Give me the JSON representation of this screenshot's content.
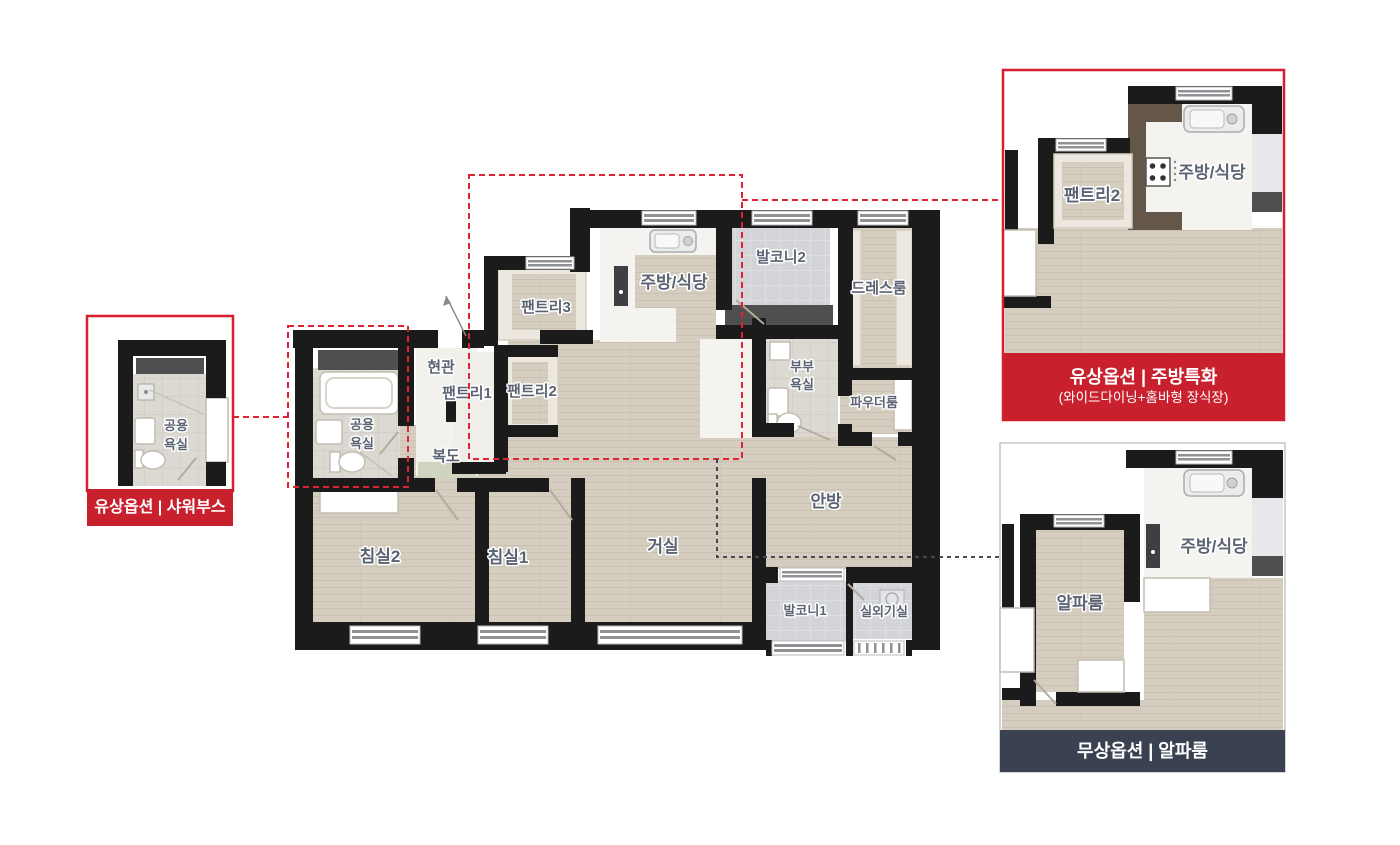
{
  "floorplan": {
    "labels": {
      "entrance": "현관",
      "pantry1": "팬트리1",
      "pantry2": "팬트리2",
      "pantry3": "팬트리3",
      "kitchen": "주방/식당",
      "balcony2": "발코니2",
      "dressroom": "드레스룸",
      "master_bath_line1": "부부",
      "master_bath_line2": "욕실",
      "powder_room": "파우더룸",
      "common_bath_line1": "공용",
      "common_bath_line2": "욕실",
      "corridor": "복도",
      "bedroom2": "침실2",
      "bedroom1": "침실1",
      "living_room": "거실",
      "master_bedroom": "안방",
      "balcony1": "발코니1",
      "outdoor_unit": "실외기실"
    }
  },
  "callouts": {
    "shower": {
      "badge": "유상옵션 | 샤워부스",
      "bath_line1": "공용",
      "bath_line2": "욕실"
    },
    "kitchen": {
      "badge_title": "유상옵션 | 주방특화",
      "badge_subtitle": "(와이드다이닝+홈바형 장식장)",
      "pantry2": "팬트리2",
      "kitchen": "주방/식당"
    },
    "alpha": {
      "badge": "무상옵션 | 알파룸",
      "alpha_room": "알파룸",
      "kitchen": "주방/식당"
    }
  },
  "colors": {
    "accent_red": "#c9202e",
    "dashed_red": "#e02330",
    "banner_dark": "#3a4150",
    "wall": "#1b1b1b",
    "floor_wood": "#d5cec0",
    "label_text": "#5c6474"
  }
}
